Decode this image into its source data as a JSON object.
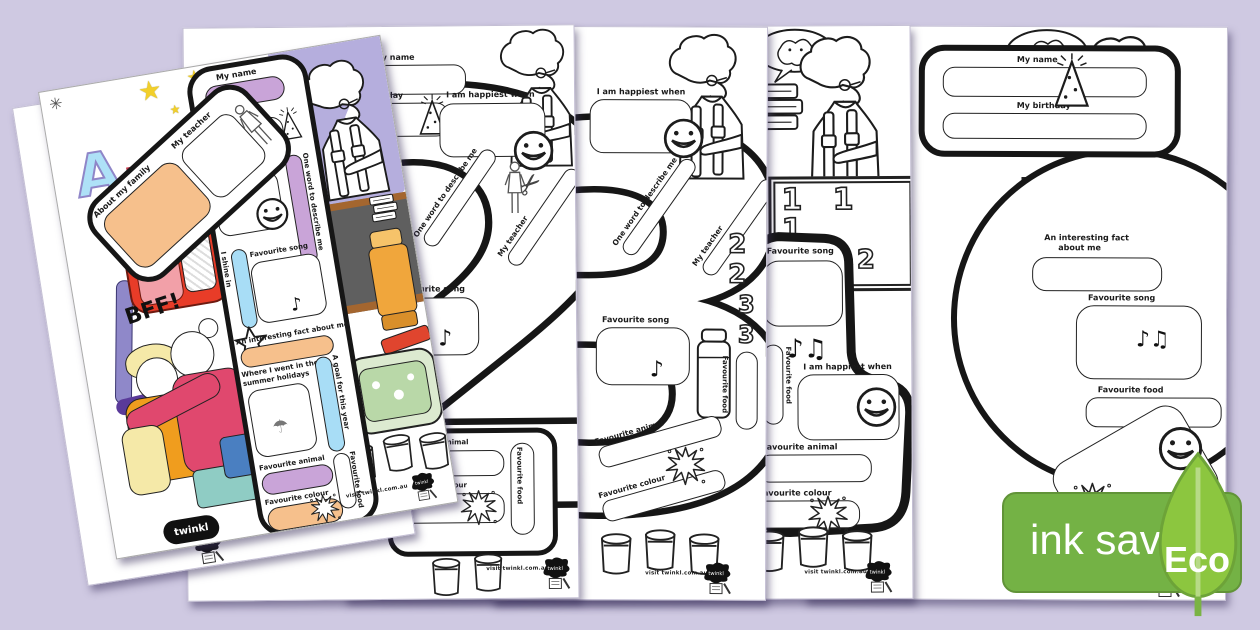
{
  "background_color": "#cfc9e2",
  "eco_badge": {
    "label": "ink saving",
    "eco": "Eco",
    "bar_color": "#74b245",
    "leaf_color": "#8cc63f"
  },
  "footer": {
    "visit": "visit twinkl.com.au",
    "brand": "twinkl"
  },
  "board_rows": {
    "r1": "1 1 1",
    "r2": "2 2",
    "r3": "3 3 3"
  },
  "icons": {
    "music": "♪♫",
    "note": "♪",
    "star": "★",
    "sparkle": "✳",
    "umbrella": "☂",
    "scissors": "✂"
  },
  "colored_page": {
    "number": "1",
    "labels": {
      "my_name": "My name",
      "my_teacher": "My teacher",
      "about_family": "About my family",
      "my_birthday": "My birthday",
      "happiest": "I am happiest when",
      "one_word": "One word to describe me",
      "shine": "I shine in",
      "song": "Favourite song",
      "fact": "An interesting fact about me",
      "where1": "Where I went in the",
      "where2": "summer holidays",
      "goal": "A goal for this year",
      "animal": "Favourite animal",
      "colour": "Favourite colour",
      "food": "Favourite food",
      "bff": "BFF!",
      "letter_a": "A",
      "letter_b": "B"
    },
    "colors": {
      "purple_pill": "#c9a4d8",
      "blue_pill": "#a8ddf6",
      "peach_pill": "#f6c08c",
      "wall": "#b5aedd",
      "board": "#5f5f5f",
      "board_frame": "#a4662f",
      "backpack": "#e83c28",
      "backpack_pocket": "#f2a0a8",
      "glue": "#f0a63c",
      "pencil_case": "#dcead0",
      "pencil_case_inner": "#b9d8a8",
      "book_red": "#c43a2e",
      "book_blue": "#3a74c4",
      "girl_top_mustard": "#f09d1e",
      "girl_top_yellow": "#f5e9a8",
      "girl_cardigan_pink": "#e0486e",
      "skirt_teal": "#8fccc4",
      "jeans_blue": "#4a7fc1",
      "pen_purple": "#8f88c9"
    }
  },
  "bw_pages": {
    "two": {
      "number": "2",
      "labels": {
        "name": "My name",
        "birthday": "My birthday",
        "happiest": "I am happiest when",
        "one_word": "One word to describe me",
        "teacher": "My teacher",
        "song": "Favourite song",
        "animal": "Favourite animal",
        "colour": "Favourite colour",
        "food": "Favourite food"
      }
    },
    "three": {
      "number": "3",
      "labels": {
        "happiest": "I am happiest when",
        "one_word": "One word to describe me",
        "teacher": "My teacher",
        "song": "Favourite song",
        "food": "Favourite food",
        "animal": "Favourite animal",
        "colour": "Favourite colour"
      }
    },
    "four": {
      "labels": {
        "song": "Favourite song",
        "food": "Favourite food",
        "happiest": "I am happiest when",
        "animal": "Favourite animal",
        "colour": "Favourite colour"
      }
    },
    "five": {
      "labels": {
        "name": "My name",
        "birthday": "My birthday",
        "fact1": "An interesting fact",
        "fact2": "about me",
        "song": "Favourite song",
        "food": "Favourite food",
        "happiest": "I am happiest when"
      }
    }
  }
}
